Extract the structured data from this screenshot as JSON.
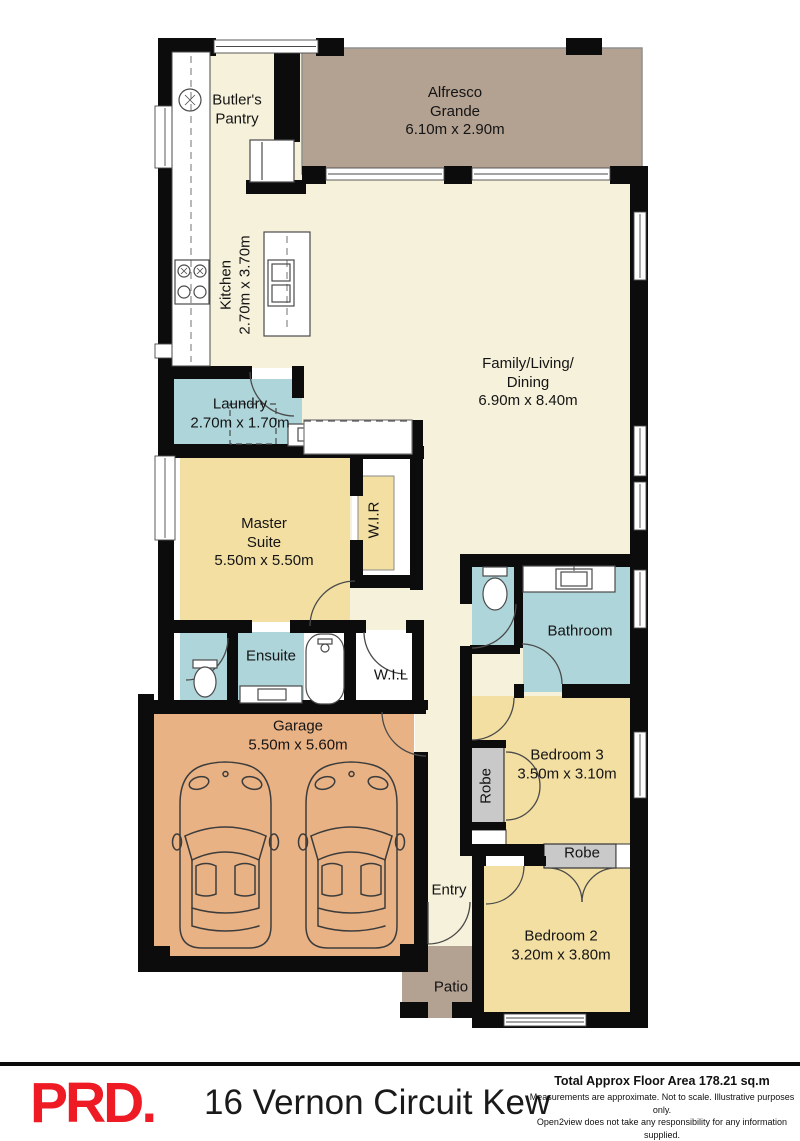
{
  "plan": {
    "rooms": {
      "butlers_pantry": {
        "lines": [
          "Butler's",
          "Pantry"
        ]
      },
      "alfresco": {
        "lines": [
          "Alfresco",
          "Grande",
          "6.10m x 2.90m"
        ]
      },
      "kitchen": {
        "lines": [
          "Kitchen",
          "2.70m x 3.70m"
        ]
      },
      "family": {
        "lines": [
          "Family/Living/",
          "Dining",
          "6.90m x 8.40m"
        ]
      },
      "laundry": {
        "lines": [
          "Laundry",
          "2.70m x 1.70m"
        ]
      },
      "master": {
        "lines": [
          "Master",
          "Suite",
          "5.50m x 5.50m"
        ]
      },
      "wir": {
        "lines": [
          "W.I.R"
        ]
      },
      "ensuite": {
        "lines": [
          "Ensuite"
        ]
      },
      "wil": {
        "lines": [
          "W.I.L"
        ]
      },
      "bathroom": {
        "lines": [
          "Bathroom"
        ]
      },
      "garage": {
        "lines": [
          "Garage",
          "5.50m x 5.60m"
        ]
      },
      "robe_bed3": {
        "lines": [
          "Robe"
        ]
      },
      "bedroom3": {
        "lines": [
          "Bedroom 3",
          "3.50m x 3.10m"
        ]
      },
      "robe_bed2": {
        "lines": [
          "Robe"
        ]
      },
      "entry": {
        "lines": [
          "Entry"
        ]
      },
      "bedroom2": {
        "lines": [
          "Bedroom 2",
          "3.20m x 3.80m"
        ]
      },
      "patio": {
        "lines": [
          "Patio"
        ]
      }
    },
    "colors": {
      "wall": "#0c0c0c",
      "living_cream": "#f6f1da",
      "bedroom_yellow": "#f3dfa2",
      "wet_area_blue": "#aed5da",
      "garage_tan": "#e9b284",
      "outdoor_brown": "#b3a192",
      "robe_grey": "#c9c9c9",
      "logo_red": "#ee1b24"
    }
  },
  "footer": {
    "logo": "PRD.",
    "address": "16 Vernon Circuit Kew",
    "floor_area": "Total Approx Floor Area 178.21 sq.m",
    "disclaimer_line1": "Measurements are approximate. Not to scale. Illustrative purposes only.",
    "disclaimer_line2": "Open2view does not take any responsibility for any information supplied."
  }
}
